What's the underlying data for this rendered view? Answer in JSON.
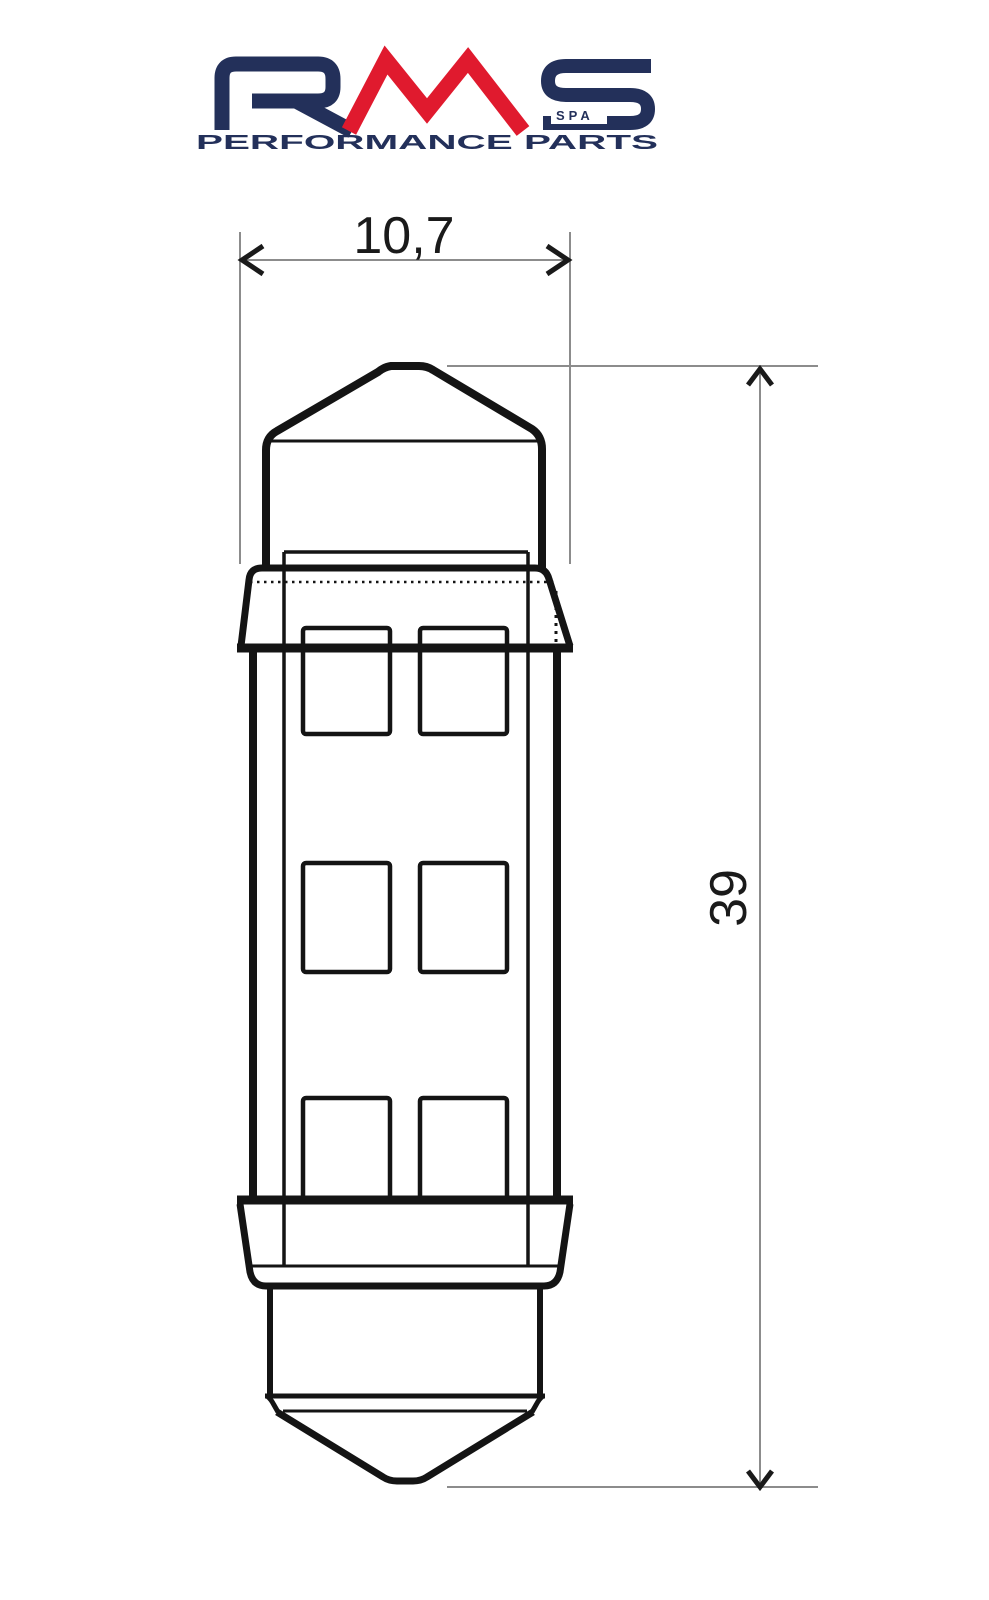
{
  "logo": {
    "brand": "RMS",
    "spa": "SPA",
    "tagline": "PERFORMANCE PARTS",
    "navy": "#23305a",
    "red": "#e01a2e"
  },
  "dimensions": {
    "width_label": "10,7",
    "height_label": "39"
  },
  "colors": {
    "line": "#141414",
    "dimension_line": "#8c8c8c",
    "text": "#1a1a1a",
    "background": "#ffffff"
  },
  "drawing": {
    "subject": "festoon LED bulb",
    "led_grid": {
      "rows": 3,
      "columns": 2
    }
  }
}
